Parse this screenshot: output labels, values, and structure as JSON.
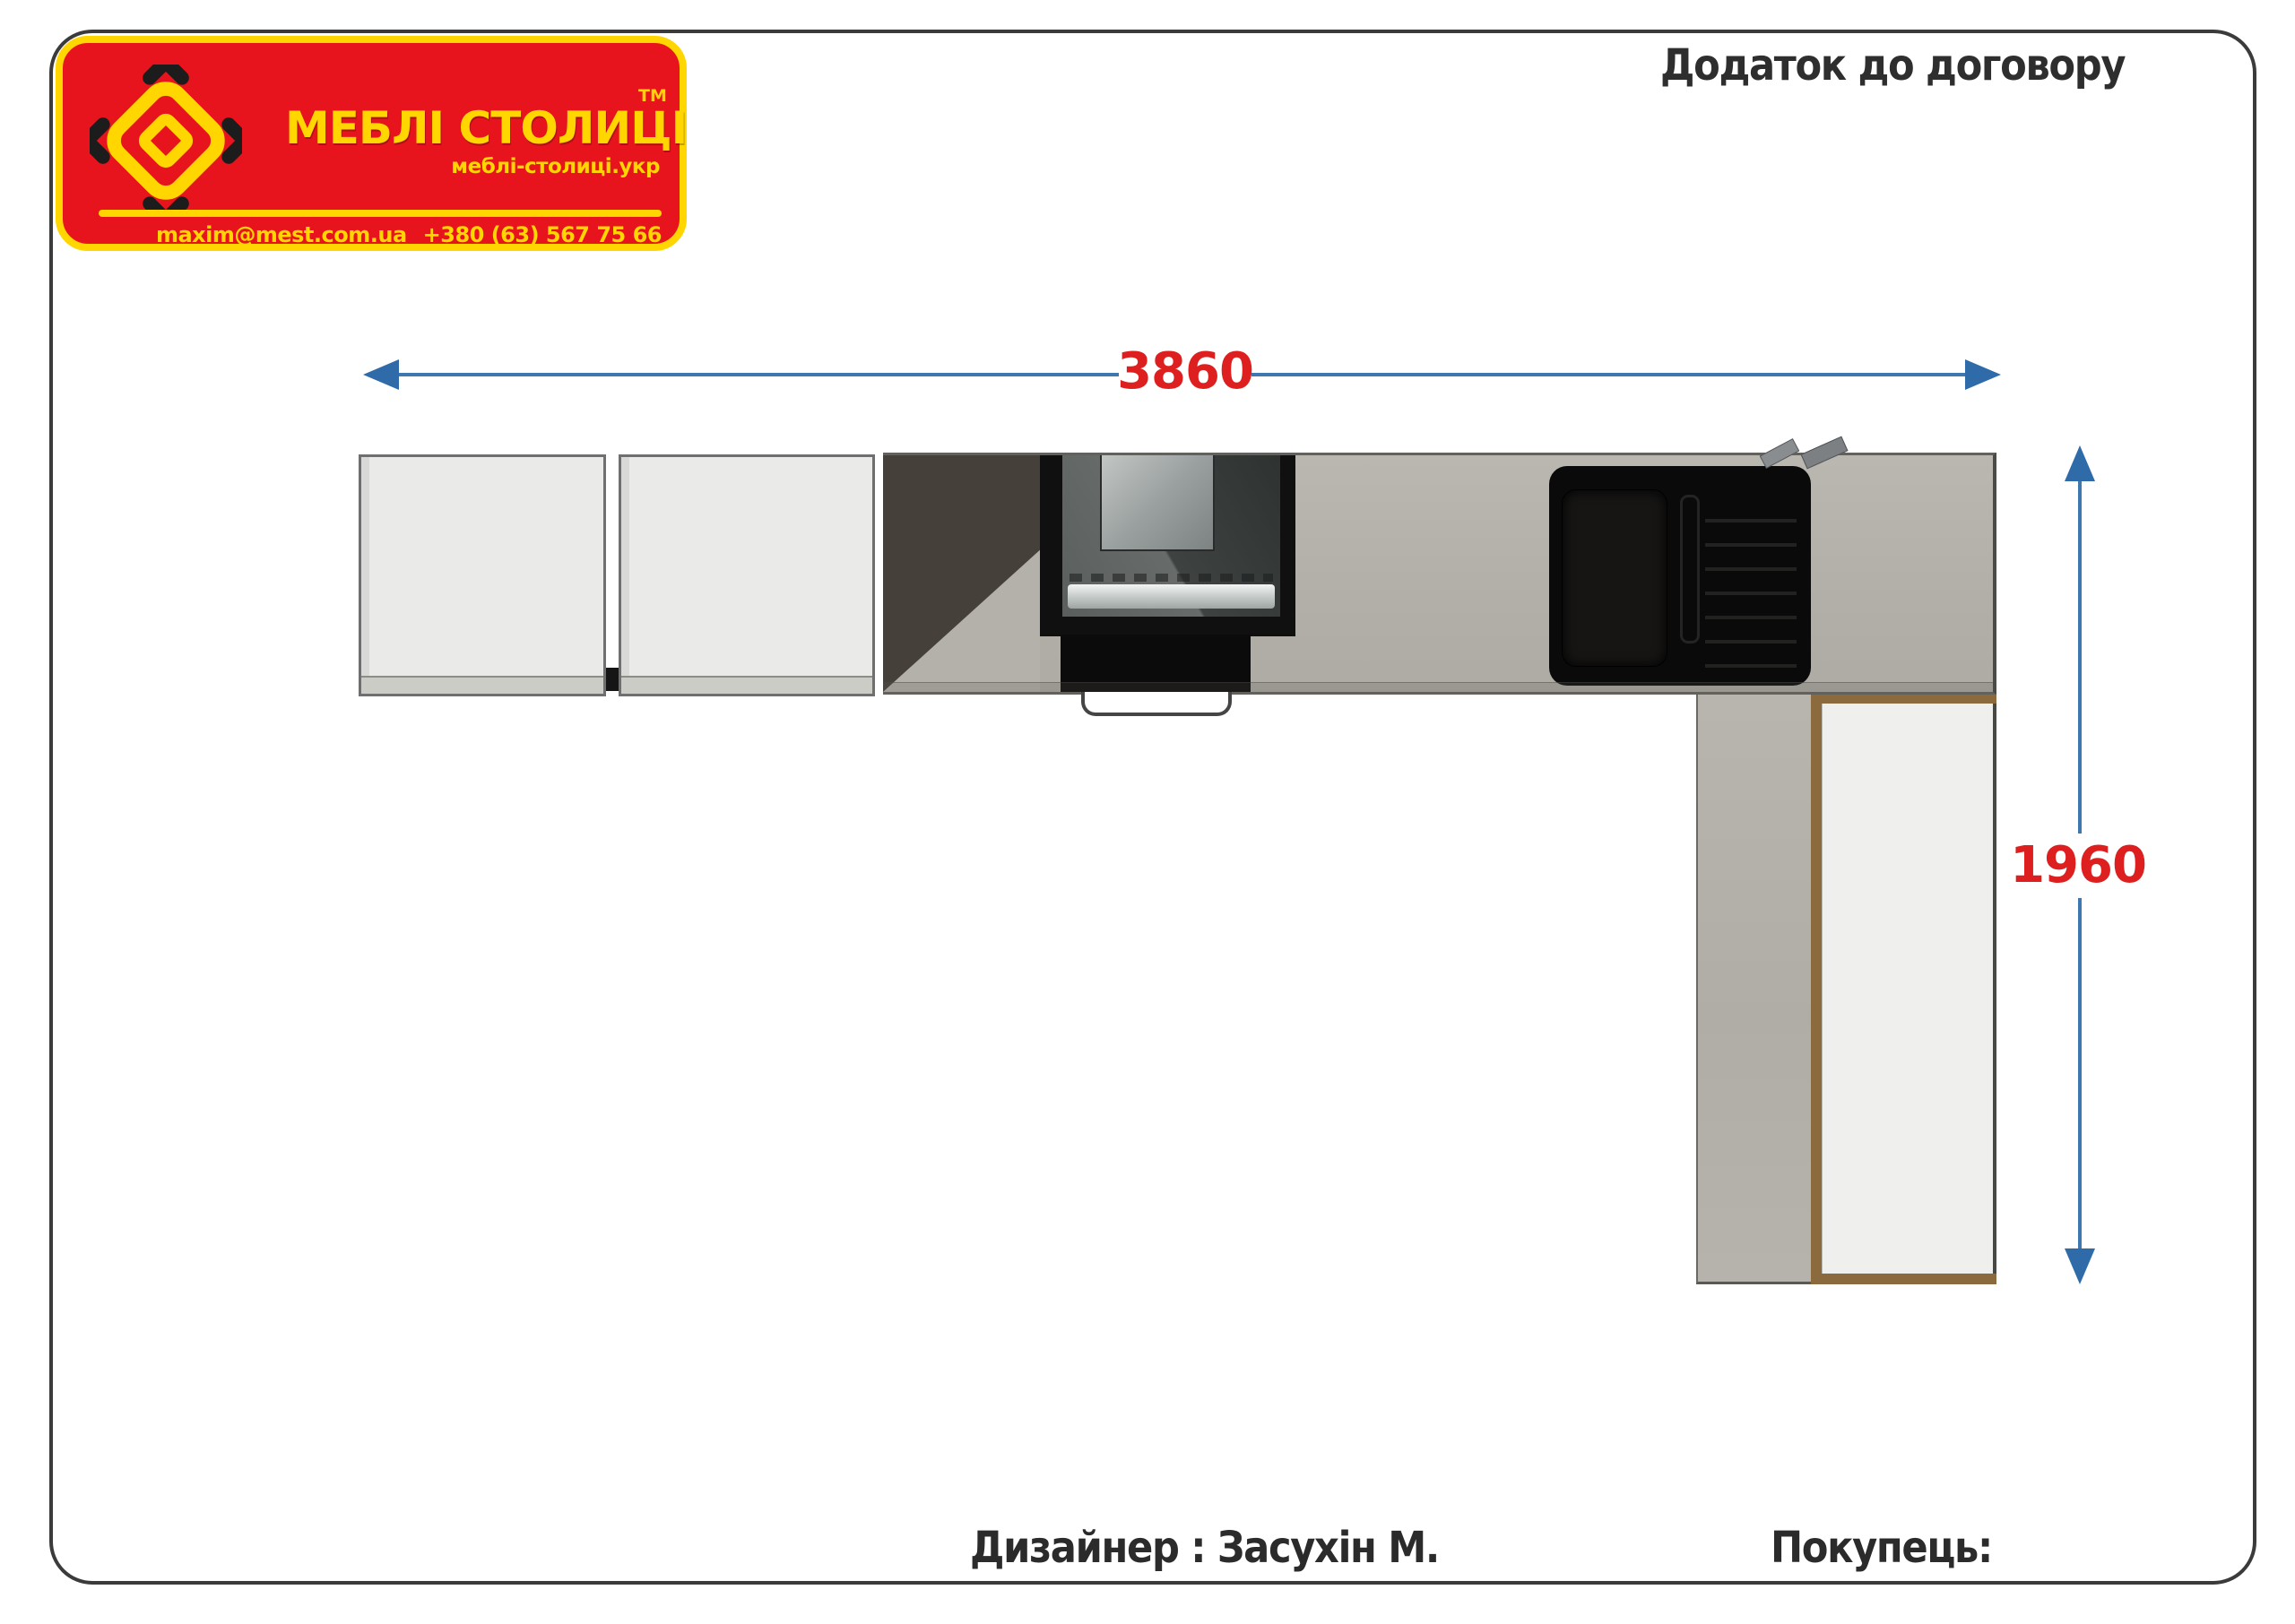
{
  "page": {
    "title": "Додаток до договору"
  },
  "logo": {
    "brand": "МЕБЛІ СТОЛИЦІ",
    "tm": "ТМ",
    "site": "меблі-столиці.укр",
    "email": "maxim@mest.com.ua",
    "phone": "+380 (63) 567 75 66"
  },
  "dimensions": {
    "width_mm": "3860",
    "height_mm": "1960"
  },
  "footer": {
    "designer": "Дизайнер : Засухін М.",
    "buyer": "Покупець:"
  },
  "icons": {
    "logo": "diamond-logo-icon"
  },
  "colors": {
    "red": "#e8141d",
    "yellow": "#ffd600",
    "blue": "#3f77b0",
    "blue_dark": "#2e6ba8",
    "dim_red": "#dd1f1f",
    "ink": "#2e2e2e",
    "border": "#3b3b3b",
    "concrete": "#b5b2ab",
    "shadow_dark": "#45403a",
    "tan": "#8b6a3e",
    "cabinet": "#eaeae9",
    "appliance": "#101010"
  }
}
